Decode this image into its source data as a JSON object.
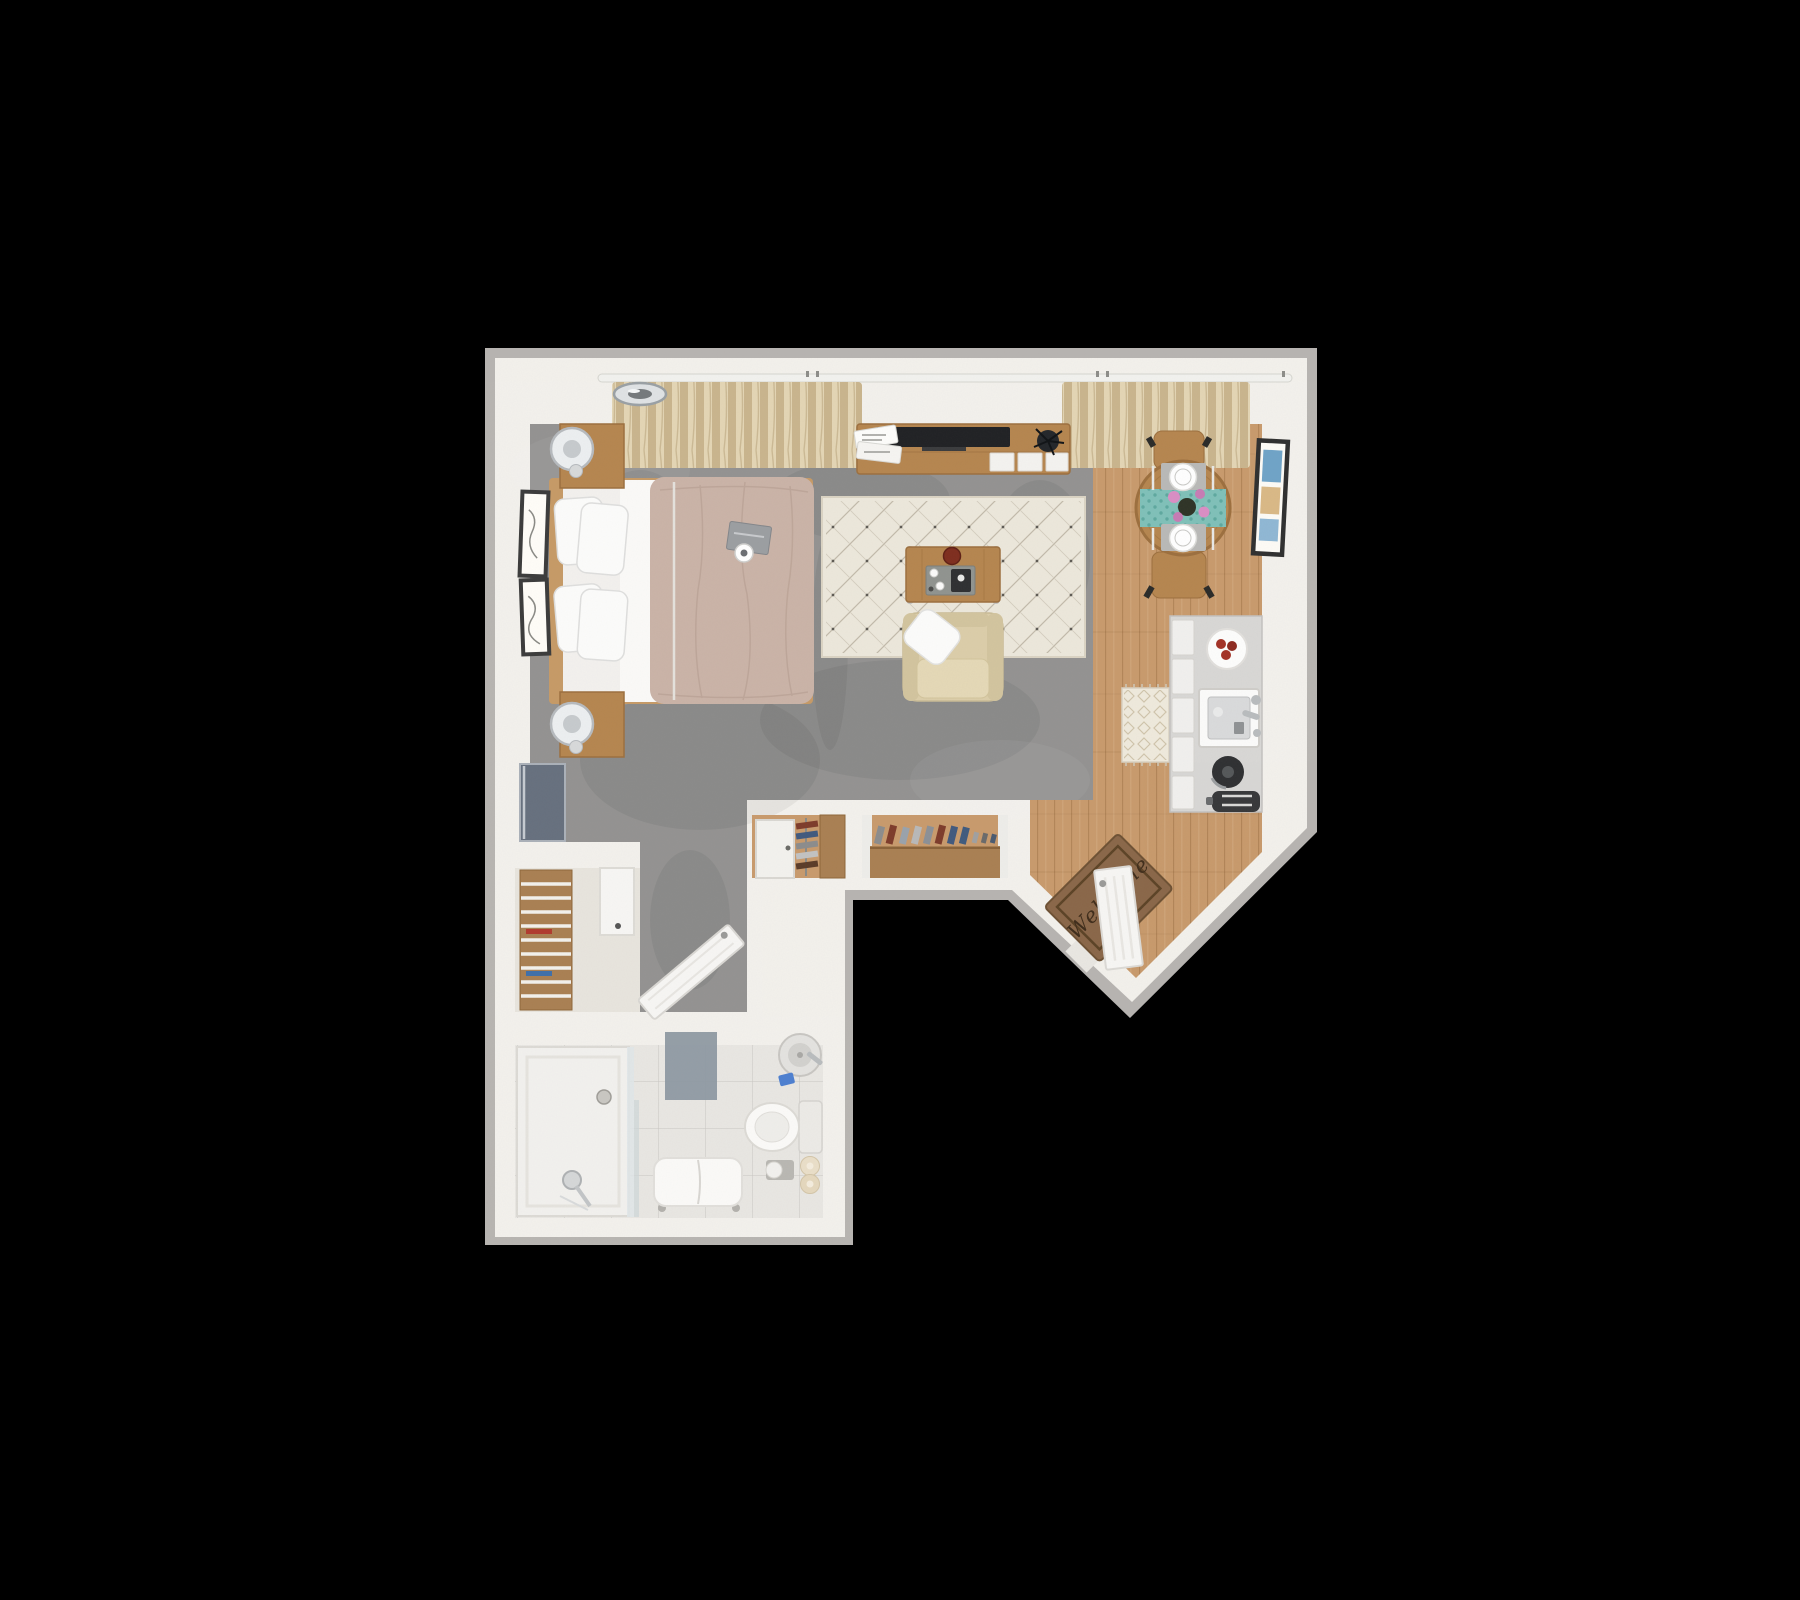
{
  "scene": {
    "kind": "3d-floor-plan-render",
    "view": "top-down studio apartment",
    "background": "#000000"
  },
  "entry": {
    "welcome_mat_text": "Welcome"
  },
  "palette": {
    "bg": "#000000",
    "wall_outer": "#b7b4b1",
    "wall_inner": "#f3f1ec",
    "carpet": "#939291",
    "wood_floor": "#c89a6c",
    "wood_furniture": "#b5854f",
    "wood_dark": "#9c6f3e",
    "closet_wood": "#a97f52",
    "closet_floor": "#e7e4dd",
    "rug": "#ece7db",
    "tile": "#e8e6e2",
    "shower_floor": "#f2f1ee",
    "counter": "#d8d7d5",
    "cabinet": "#f1f0ee",
    "duvet": "#cab3a7",
    "sheet": "#fbfaf8",
    "pillow": "#fcfcfb",
    "mattress": "#f3f1ee",
    "armchair": "#dbcda9",
    "cushion": "#e4d8b6",
    "curtain": "#dbcca9",
    "teal_runner": "#7fc0b8",
    "placemat": "#b9b9b7",
    "mat_brown": "#8a6749",
    "mat_border": "#5c4326",
    "mat_text_color": "#3f2d1b",
    "bath_mat": "#8e99a2",
    "door_white": "#f7f6f4",
    "tv_black": "#202124",
    "panel_gray": "#66707e",
    "frame_dark": "#333333",
    "art_blue": "#6fa3c7",
    "art_tan": "#d9b886",
    "flower_pink": "#d98ec4",
    "chrome": "#dfe2e4",
    "lamp_white": "#eceff1",
    "red_accent": "#a33226",
    "kettle_dark": "#2f3032",
    "bench_white": "#fbfaf8",
    "toilet_white": "#fbfaf8",
    "towel_beige": "#e9dec8"
  },
  "items": [
    "ceiling-light",
    "window-curtains",
    "curtain-rod",
    "tv-console",
    "television",
    "magazine-stack",
    "potted-plant",
    "bed",
    "bed-pillows",
    "duvet",
    "folded-sheet",
    "book-and-mug",
    "nightstand",
    "table-lamp",
    "wall-art-frames",
    "leaning-tv-panel",
    "area-rug",
    "coffee-table",
    "espresso-tray",
    "armchair",
    "throw-pillow",
    "dining-table",
    "dining-chair",
    "table-runner",
    "place-setting",
    "flower-vase",
    "framed-art",
    "kitchen-counter",
    "kitchen-sink",
    "kettle",
    "toaster",
    "fruit-plate",
    "kitchen-runner-rug",
    "linen-closet",
    "linen-shelves",
    "closet-door",
    "wardrobe",
    "hanging-clothes",
    "shoe-closet",
    "shoe-row",
    "bathroom-door",
    "walk-in-shower",
    "shower-drain",
    "hand-shower",
    "bath-mat",
    "shower-bench",
    "toilet",
    "towel-rolls",
    "toilet-paper",
    "bathroom-sink",
    "toothbrush-cup",
    "entry-door",
    "welcome-mat"
  ]
}
